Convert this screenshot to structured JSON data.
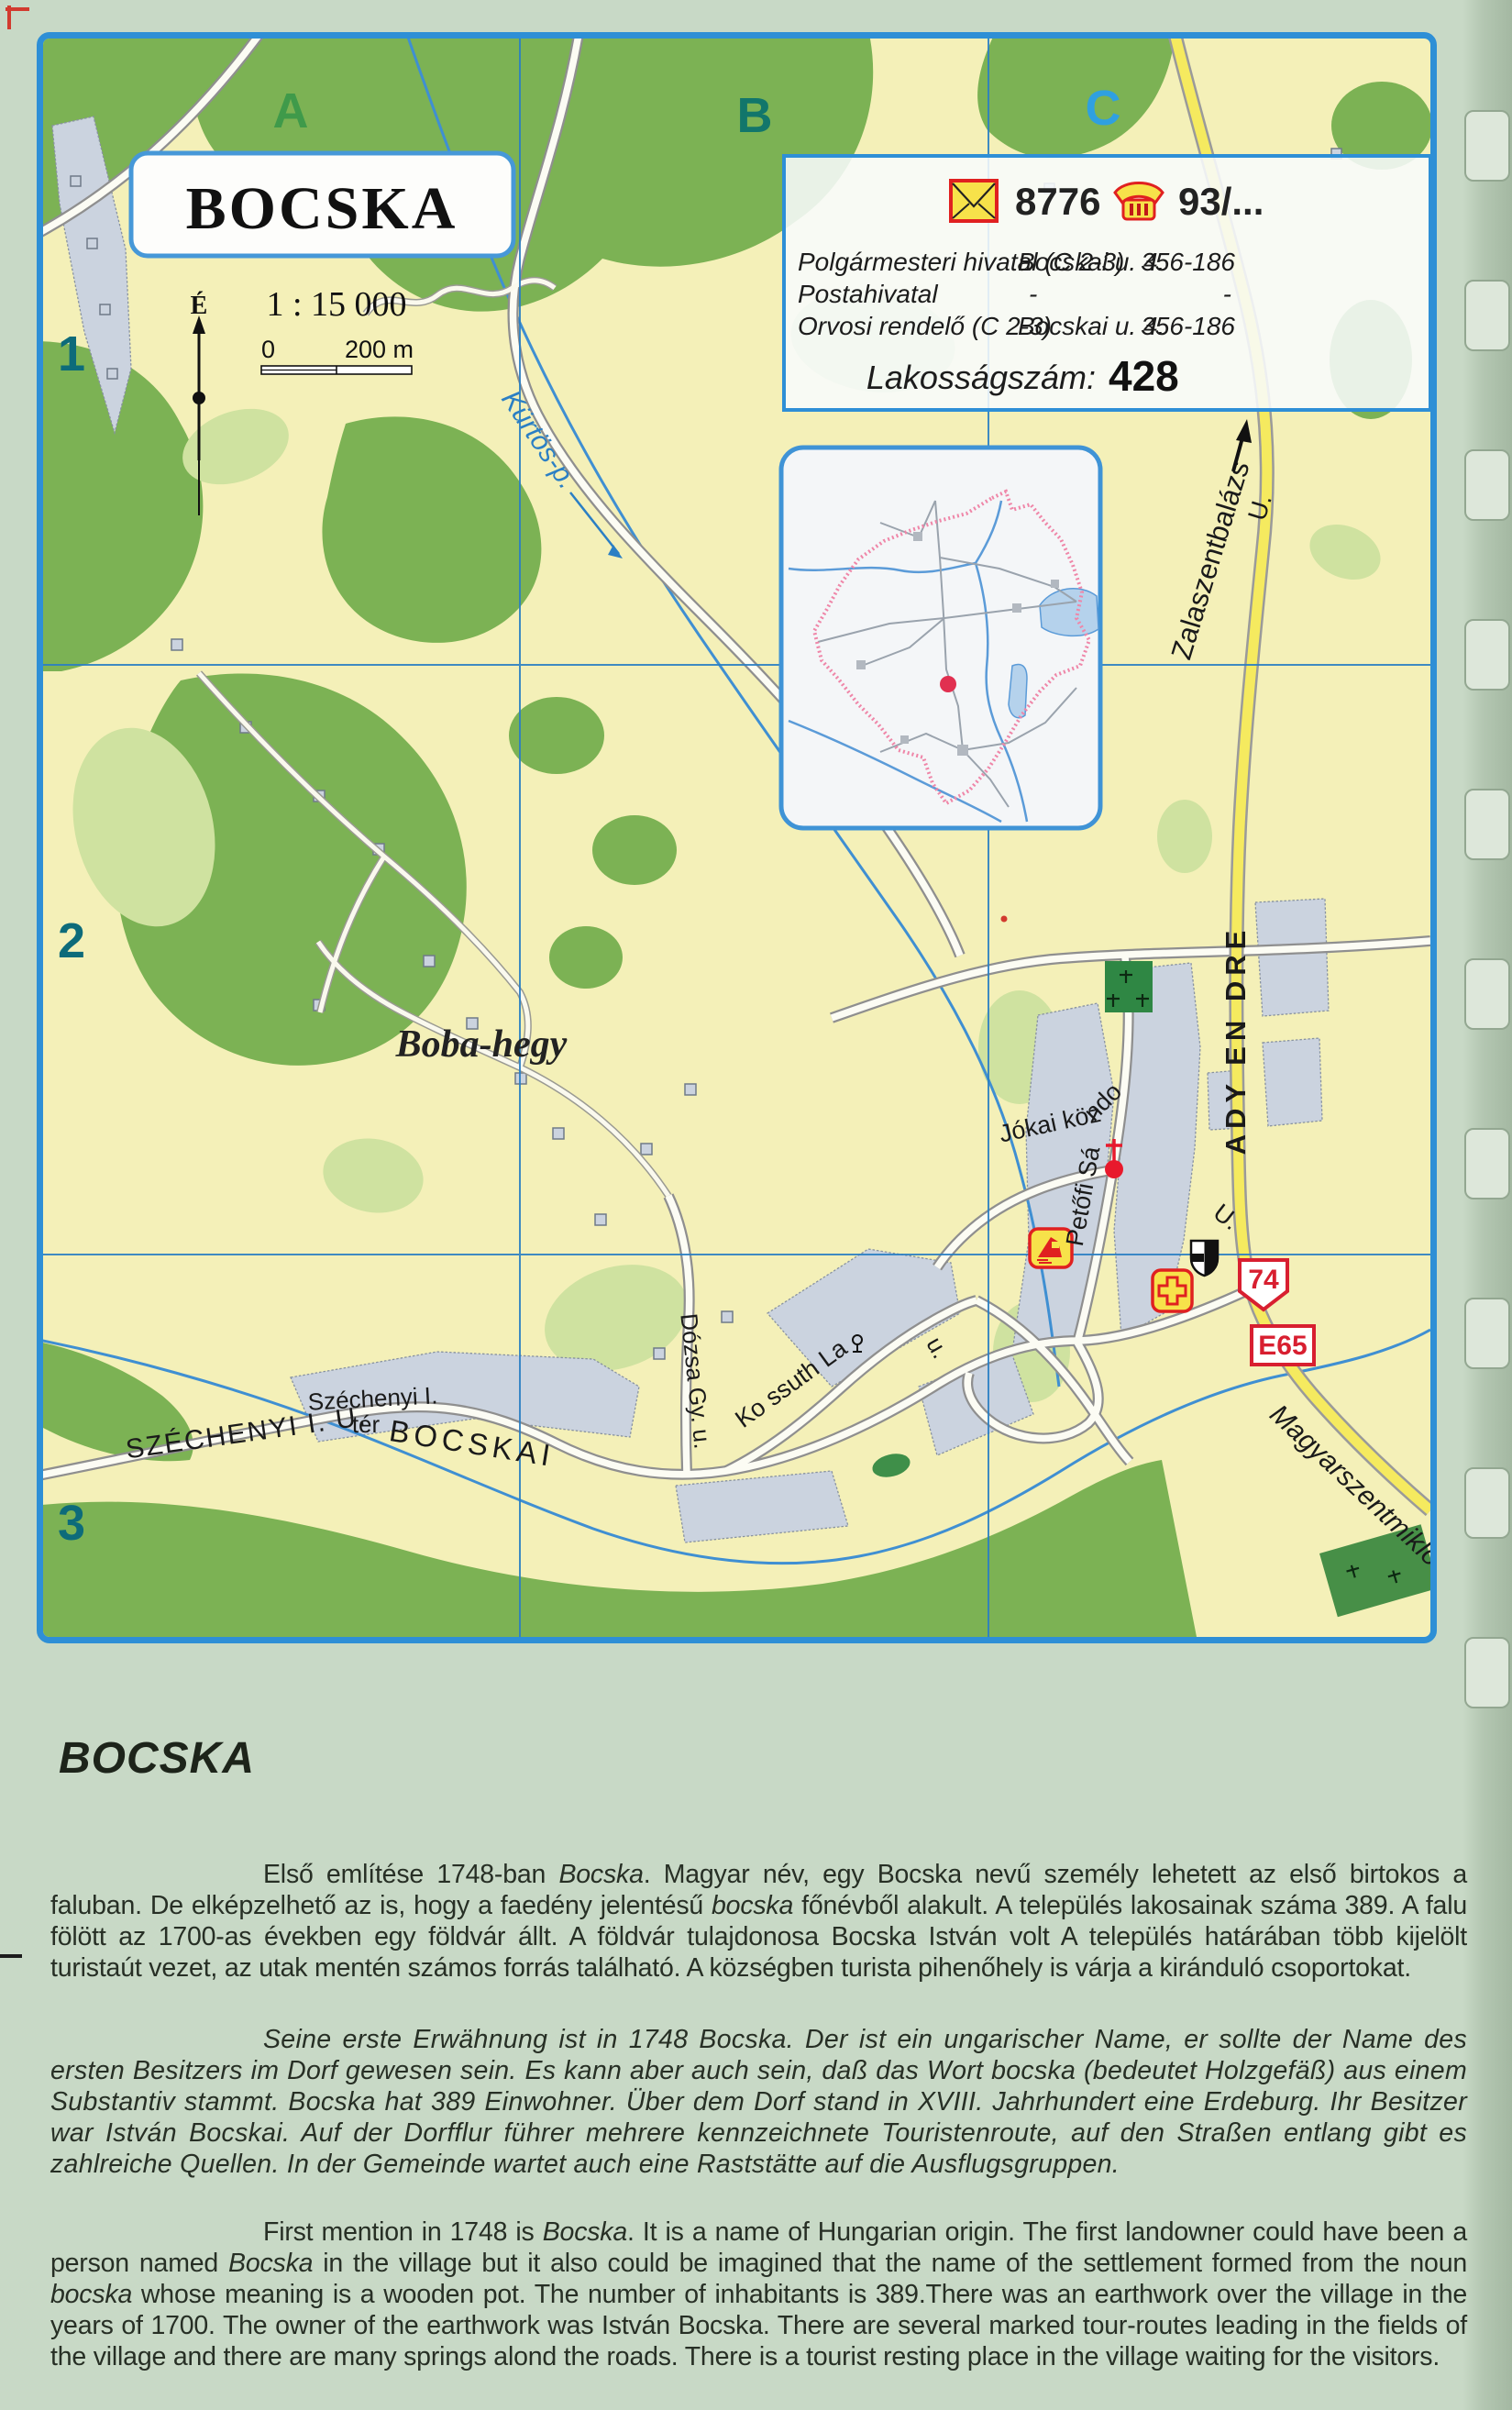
{
  "page": {
    "background": "#c8d9c6",
    "accent_blue": "#2e8fd6"
  },
  "map": {
    "title": "BOCSKA",
    "scale_text": "1 : 15 000",
    "scale_zero": "0",
    "scale_distance": "200 m",
    "compass_north": "É",
    "grid": {
      "cols": [
        "A",
        "B",
        "C"
      ],
      "rows": [
        "1",
        "2",
        "3"
      ]
    },
    "info_box": {
      "postal_code": "8776",
      "phone_prefix": "93/...",
      "rows": [
        {
          "name": "Polgármesteri hivatal (C 2-3)",
          "address": "Bocskai u. 4.",
          "phone": "356-186"
        },
        {
          "name": "Postahivatal",
          "address": "-",
          "phone": "-"
        },
        {
          "name": "Orvosi rendelő (C 2-3)",
          "address": "Bocskai u. 4.",
          "phone": "356-186"
        }
      ],
      "population_label": "Lakosságszám:",
      "population_value": "428"
    },
    "labels": {
      "kurtos": "Kürtös-p.",
      "zalaszentbalazs": "Zalaszentbalázs",
      "zala_u": "U.",
      "ady_endre": "ADY EN DRE",
      "jokai": "Jókai köz",
      "petofi_1": "Petőfi Sá",
      "petofi_2": "ndo",
      "petofi_u_small": "U.",
      "boba_hegy": "Boba-hegy",
      "dozsa": "Dózsa Gy. u.",
      "kossuth": "Ko ssuth La",
      "kossuth_u": "u.",
      "szechenyi_u": "SZÉCHENYI I. U.",
      "szechenyi_ter_1": "Széchenyi I.",
      "szechenyi_ter_2": "tér",
      "bocskai": "BOCSKAI",
      "magyarszentmiklos": "Magyarszentmiklós",
      "route_74": "74",
      "route_e65": "E65"
    },
    "icons": {
      "envelope": "envelope-icon",
      "phone": "phone-icon",
      "church": "church-icon",
      "cemetery": "cemetery-icon",
      "first_aid": "cross-icon",
      "coat_of_arms": "shield-icon",
      "tourist_rest": "tourist-rest-icon",
      "north_arrow": "compass-north-icon"
    },
    "colors": {
      "forest": "#7cb254",
      "field_light": "#cfe2a0",
      "built_up": "#cbd3df",
      "main_road": "#f5ea5f",
      "water": "#3f8fd2",
      "grid_line": "#2b7fc4",
      "route_sign_red": "#d81f30",
      "boundary_pink": "#ef86a8"
    }
  },
  "article": {
    "heading": "BOCSKA",
    "paragraph_hu": [
      {
        "t": "Első említése 1748-ban "
      },
      {
        "t": "Bocska",
        "i": true
      },
      {
        "t": ". Magyar név, egy Bocska nevű személy lehetett az első birtokos a faluban. De elképzelhető az is, hogy a faedény jelentésű "
      },
      {
        "t": "bocska",
        "i": true
      },
      {
        "t": " főnévből alakult. A település lakosainak száma 389. A falu fölött az 1700-as években egy földvár állt. A földvár tulajdonosa Bocska István volt A település határában több kijelölt turistaút vezet, az utak mentén számos forrás található. A községben turista pihenőhely is várja a kiránduló csoportokat."
      }
    ],
    "paragraph_de": "Seine erste Erwähnung ist in 1748 Bocska. Der ist ein ungarischer Name, er sollte der Name des ersten Besitzers im Dorf gewesen sein. Es kann aber auch sein, daß das Wort bocska (bedeutet Holzgefäß) aus einem Substantiv stammt. Bocska hat 389 Einwohner. Über dem Dorf stand in XVIII. Jahrhundert eine Erdeburg. Ihr Besitzer war István Bocskai. Auf der Dorfflur führer mehrere kennzeichnete Touristenroute, auf den Straßen entlang gibt es zahlreiche Quellen. In der Gemeinde wartet auch eine Raststätte auf die Ausflugsgruppen.",
    "paragraph_en": [
      {
        "t": "First mention in 1748 is "
      },
      {
        "t": "Bocska",
        "i": true
      },
      {
        "t": ". It is a name of Hungarian origin. The first landowner could have been a person named "
      },
      {
        "t": "Bocska",
        "i": true
      },
      {
        "t": " in the village but it also could be imagined that the name of the settlement formed from the noun "
      },
      {
        "t": "bocska",
        "i": true
      },
      {
        "t": " whose meaning is a wooden pot. The number of inhabitants is 389.There was an earthwork over the village in the years of 1700. The owner of the earthwork was István Bocska. There are several marked tour-routes leading in the fields of the village and there are many springs alond the roads. There is a tourist resting place in the village waiting for the visitors."
      }
    ]
  }
}
